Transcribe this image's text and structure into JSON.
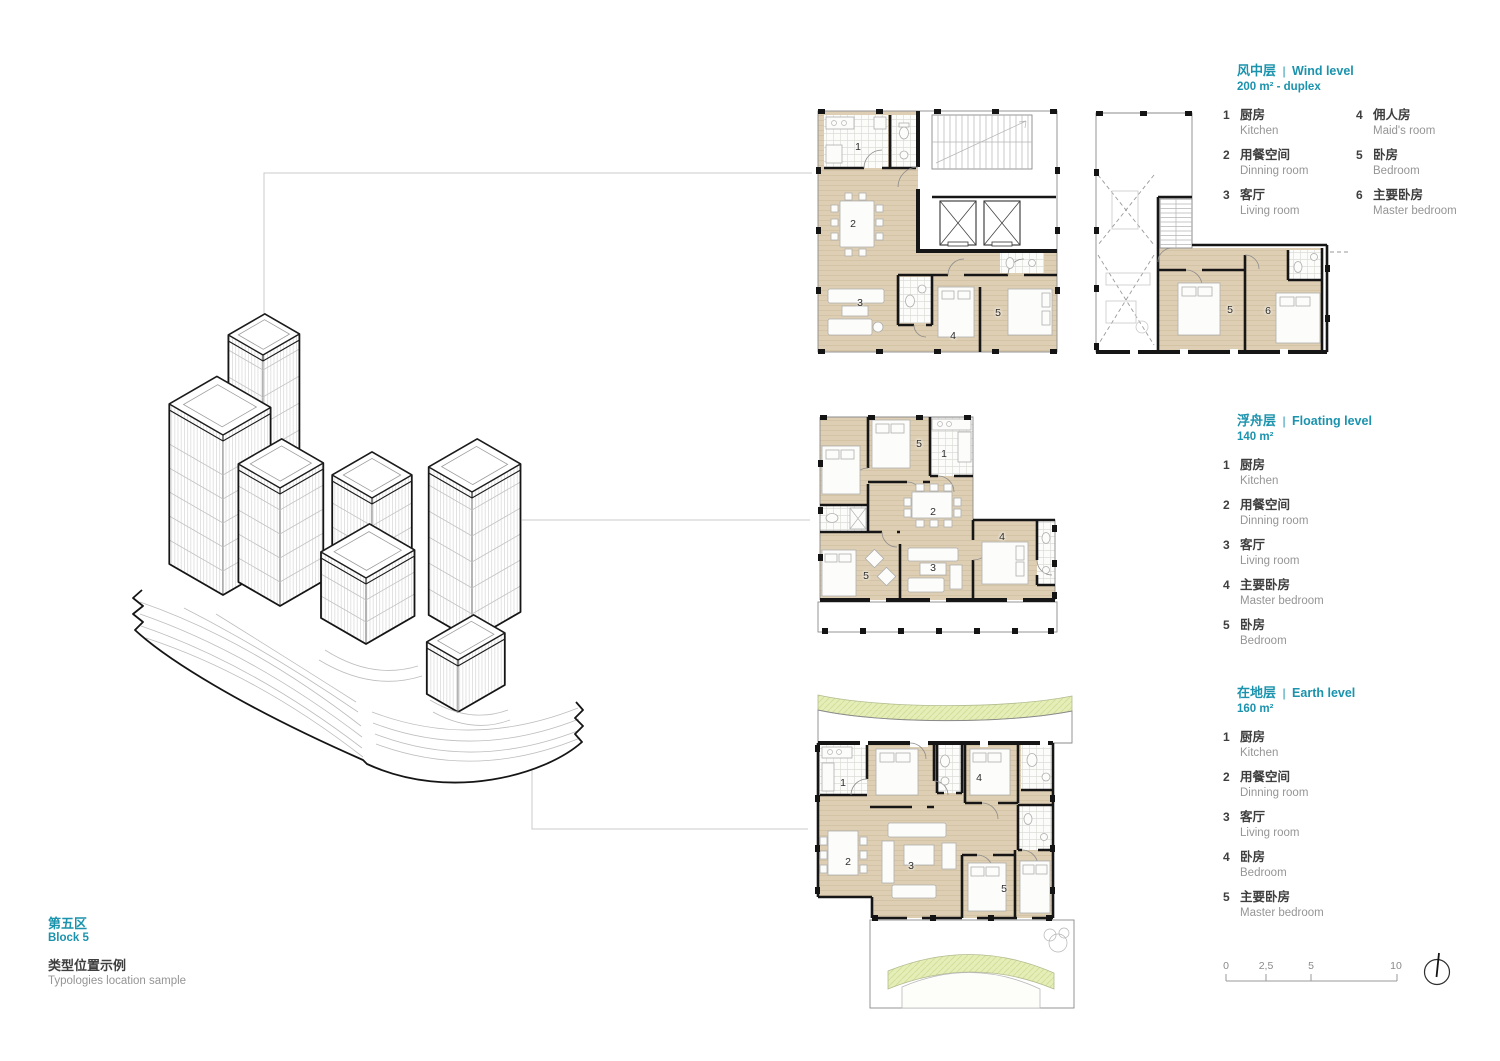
{
  "titles": {
    "block_zh": "第五区",
    "block_en": "Block 5",
    "sample_zh": "类型位置示例",
    "sample_en": "Typologies location sample"
  },
  "legends": {
    "wind": {
      "zh": "风中层",
      "sep": "|",
      "en": "Wind level",
      "area": "200 m² - duplex",
      "items": [
        {
          "num": "1",
          "zh": "厨房",
          "en": "Kitchen"
        },
        {
          "num": "2",
          "zh": "用餐空间",
          "en": "Dinning room"
        },
        {
          "num": "3",
          "zh": "客厅",
          "en": "Living room"
        },
        {
          "num": "4",
          "zh": "佣人房",
          "en": "Maid's room"
        },
        {
          "num": "5",
          "zh": "卧房",
          "en": "Bedroom"
        },
        {
          "num": "6",
          "zh": "主要卧房",
          "en": "Master bedroom"
        }
      ]
    },
    "floating": {
      "zh": "浮舟层",
      "sep": "|",
      "en": "Floating level",
      "area": "140 m²",
      "items": [
        {
          "num": "1",
          "zh": "厨房",
          "en": "Kitchen"
        },
        {
          "num": "2",
          "zh": "用餐空间",
          "en": "Dinning room"
        },
        {
          "num": "3",
          "zh": "客厅",
          "en": "Living room"
        },
        {
          "num": "4",
          "zh": "主要卧房",
          "en": "Master bedroom"
        },
        {
          "num": "5",
          "zh": "卧房",
          "en": "Bedroom"
        }
      ]
    },
    "earth": {
      "zh": "在地层",
      "sep": "|",
      "en": "Earth level",
      "area": "160 m²",
      "items": [
        {
          "num": "1",
          "zh": "厨房",
          "en": "Kitchen"
        },
        {
          "num": "2",
          "zh": "用餐空间",
          "en": "Dinning room"
        },
        {
          "num": "3",
          "zh": "客厅",
          "en": "Living room"
        },
        {
          "num": "4",
          "zh": "卧房",
          "en": "Bedroom"
        },
        {
          "num": "5",
          "zh": "主要卧房",
          "en": "Master bedroom"
        }
      ]
    }
  },
  "plans": {
    "wind_lower": {
      "labels": [
        "1",
        "2",
        "3",
        "4",
        "5"
      ]
    },
    "wind_upper": {
      "labels": [
        "5",
        "6"
      ]
    },
    "floating": {
      "labels": [
        "5",
        "1",
        "2",
        "3",
        "4",
        "5"
      ]
    },
    "earth": {
      "labels": [
        "1",
        "4",
        "2",
        "3",
        "5"
      ]
    }
  },
  "scalebar": {
    "ticks": [
      "0",
      "2,5",
      "5",
      "10"
    ]
  },
  "colors": {
    "accent": "#1b93ad",
    "floor_beige": "#decfb4",
    "landscape_green": "#e5eeb6",
    "wall_black": "#161616"
  }
}
